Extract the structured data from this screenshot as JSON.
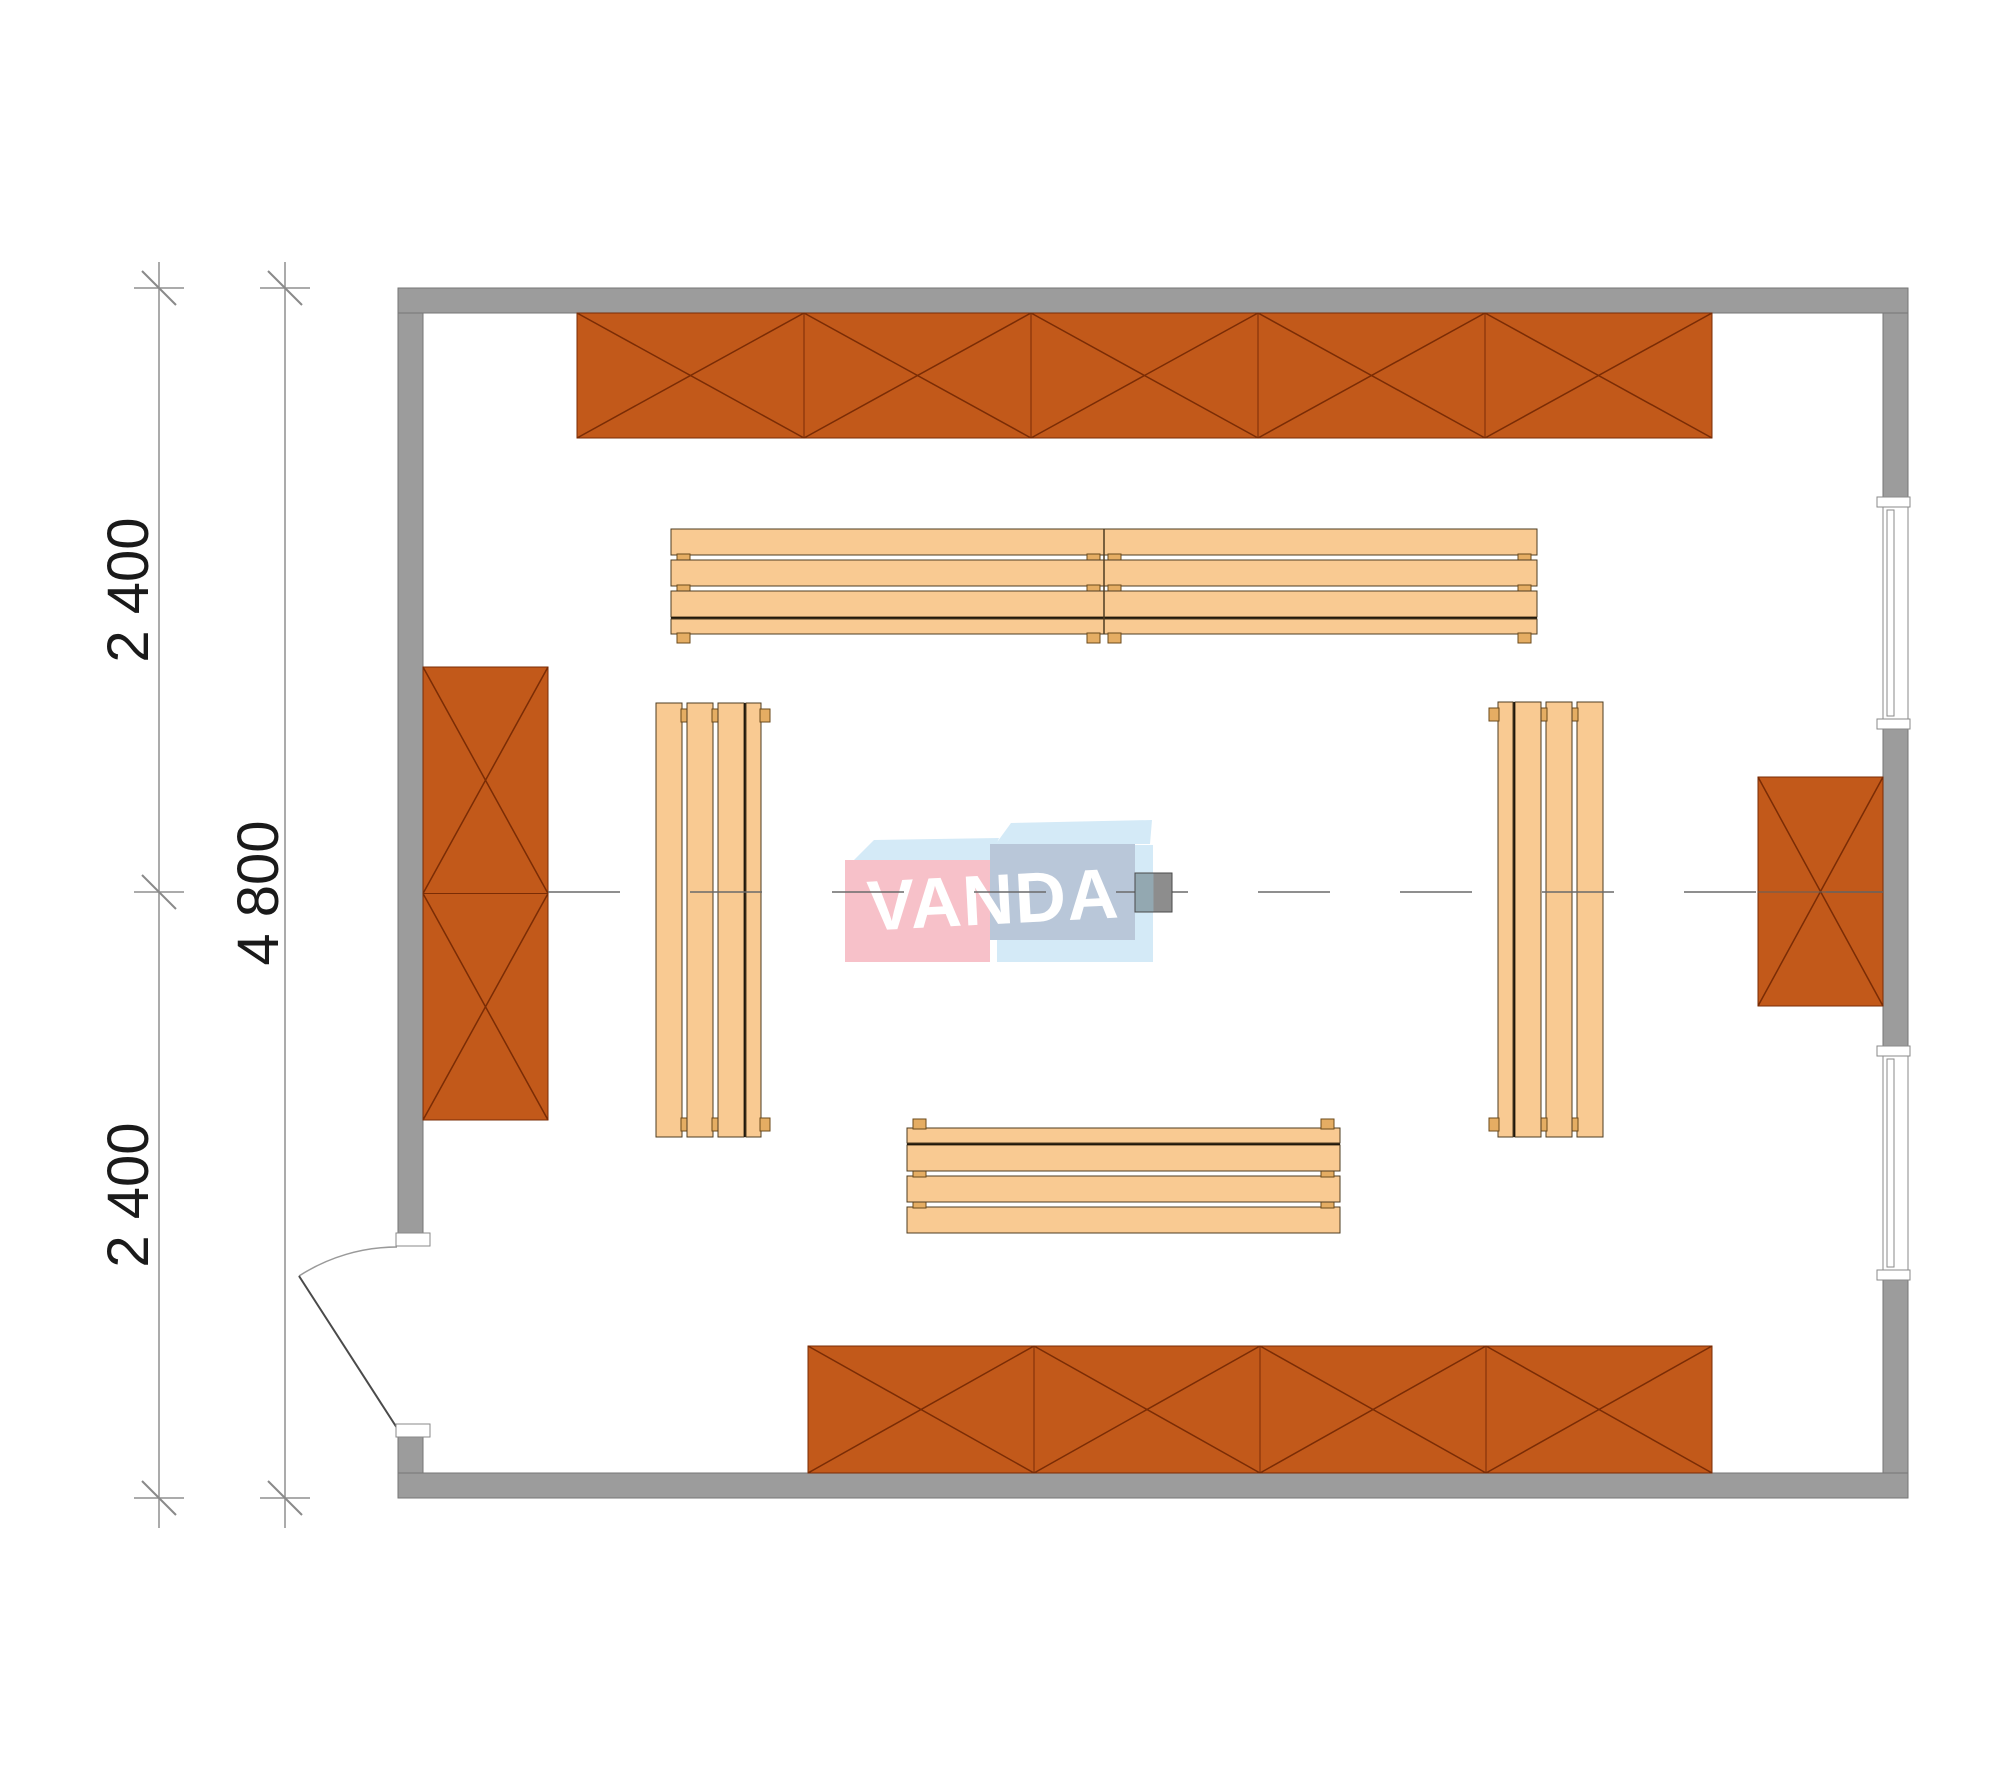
{
  "document": {
    "type": "architectural-floor-plan",
    "description": "Top view plan of a sauna/room with wall cabinets, slatted benches, stove, door and two windows"
  },
  "dimensions": {
    "left_inner_top": "2 400",
    "left_inner_bottom": "2 400",
    "left_outer": "4 800"
  },
  "watermark": {
    "text": "VANDA"
  },
  "colors": {
    "wall": "#9c9c9c",
    "wall_edge": "#767676",
    "cabinet": "#c2591a",
    "cabinet_line": "#7a2c05",
    "bench": "#f9ca92",
    "bench_line": "#4e3c22",
    "bench_leg": "#e5ad63",
    "bench_front_edge": "#20180c",
    "centerline": "#6a6a6a",
    "dimension": "#8f8f8f",
    "glazing_strip": "#adc3ca",
    "watermark_pink": "#f7c1c9",
    "watermark_blue": "#b9c7d9",
    "watermark_lightblue": "#d4eaf7",
    "stove_left": "#93a8b1",
    "stove_right": "#8d8d8d"
  },
  "plan": {
    "canvas": {
      "w": 2000,
      "h": 1786
    },
    "walls": [
      {
        "name": "wall-top",
        "x": 398,
        "y": 288,
        "w": 1510,
        "h": 25
      },
      {
        "name": "wall-bottom",
        "x": 398,
        "y": 1473,
        "w": 1510,
        "h": 25
      },
      {
        "name": "wall-left-upper",
        "x": 398,
        "y": 313,
        "w": 25,
        "h": 920
      },
      {
        "name": "wall-left-lower",
        "x": 398,
        "y": 1437,
        "w": 25,
        "h": 36
      },
      {
        "name": "wall-right-upper",
        "x": 1883,
        "y": 313,
        "w": 25,
        "h": 187
      },
      {
        "name": "wall-right-mid",
        "x": 1883,
        "y": 726,
        "w": 25,
        "h": 323
      },
      {
        "name": "wall-right-lower",
        "x": 1883,
        "y": 1277,
        "w": 25,
        "h": 196
      }
    ],
    "glazing_strip": {
      "x": 577,
      "y": 306,
      "w": 1306,
      "h": 7
    },
    "windows": [
      {
        "name": "window-right-upper",
        "x": 1883,
        "y": 500,
        "w": 25,
        "h": 226
      },
      {
        "name": "window-right-lower",
        "x": 1883,
        "y": 1049,
        "w": 25,
        "h": 228
      }
    ],
    "door": {
      "jamb_top": {
        "x": 396,
        "y": 1233,
        "w": 34,
        "h": 13
      },
      "jamb_bottom": {
        "x": 396,
        "y": 1424,
        "w": 34,
        "h": 13
      },
      "leaf": {
        "x1": 299,
        "y1": 1276,
        "x2": 397,
        "y2": 1428
      },
      "arc": "M 397 1247 A 181 181 0 0 0 299 1276"
    },
    "cabinets": [
      {
        "name": "cabinet-row-top",
        "x": 577,
        "y": 313,
        "w": 1135,
        "h": 125,
        "units": 5,
        "dir": "h"
      },
      {
        "name": "cabinet-left-wall",
        "x": 423,
        "y": 667,
        "w": 125,
        "h": 453,
        "units": 2,
        "dir": "v"
      },
      {
        "name": "cabinet-right-wall",
        "x": 1758,
        "y": 777,
        "w": 125,
        "h": 229,
        "units": 1,
        "dir": "v"
      },
      {
        "name": "cabinet-row-bottom",
        "x": 808,
        "y": 1346,
        "w": 904,
        "h": 127,
        "units": 4,
        "dir": "h"
      }
    ],
    "benches": [
      {
        "name": "bench-top",
        "start": 671,
        "len": 866,
        "back": 529,
        "dir": "down",
        "split": true
      },
      {
        "name": "bench-left",
        "start": 703,
        "len": 434,
        "back": 656,
        "dir": "right",
        "split": false
      },
      {
        "name": "bench-right",
        "start": 702,
        "len": 435,
        "back": 1603,
        "dir": "left",
        "split": false
      },
      {
        "name": "bench-bottom",
        "start": 907,
        "len": 433,
        "back": 1233,
        "dir": "up",
        "split": false
      }
    ],
    "stove": {
      "x": 1135,
      "y": 873,
      "w": 37,
      "h": 39
    },
    "centerline": {
      "y": 892,
      "x1": 548,
      "x2": 1883,
      "dash": "72 70"
    },
    "cabinet_centerline_segment": {
      "x1": 1758,
      "x2": 1883,
      "y": 892
    },
    "watermark_geometry": {
      "pink_face": {
        "x": 845,
        "y": 860,
        "w": 145,
        "h": 102
      },
      "blue_face": {
        "x": 990,
        "y": 844,
        "w": 145,
        "h": 96
      },
      "flap_left": "853,861 874,840 999,838 990,860",
      "flap_right": "995,845 1011,823 1152,820 1150,844",
      "side_shadow": "1135,845 1153,845 1153,962 997,962 997,940 1135,940"
    },
    "dims": {
      "y_top_ext": 262,
      "y_bottom_ext": 1528,
      "lines": [
        {
          "x": 159,
          "ticks": [
            288,
            892,
            1498
          ]
        },
        {
          "x": 285,
          "ticks": [
            288,
            1498
          ]
        }
      ]
    }
  }
}
